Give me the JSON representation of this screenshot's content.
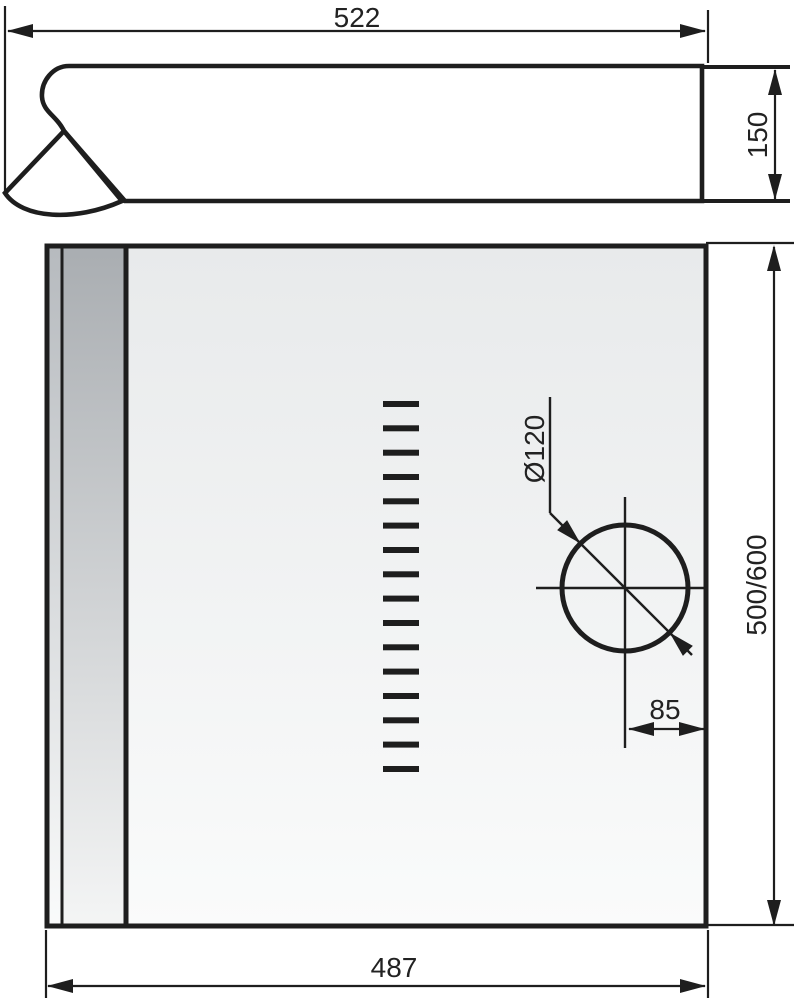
{
  "drawing": {
    "dimensions": {
      "top_width": "522",
      "side_height": "150",
      "hole_diameter": "Ø120",
      "depth": "500/600",
      "hole_offset": "85",
      "bottom_width": "487"
    },
    "plan_view": {
      "vent_slot_count": 16
    },
    "colors": {
      "line": "#1e1e1e",
      "text": "#222222",
      "body_fill_light": "#fdfdfd",
      "body_fill_dark": "#dcdee0",
      "strip_gray_dark": "#a9adb1",
      "strip_gray_light": "#b6babe",
      "panel_top": "#e8eaeb",
      "panel_bottom": "#fafbfb",
      "background": "#ffffff"
    }
  }
}
